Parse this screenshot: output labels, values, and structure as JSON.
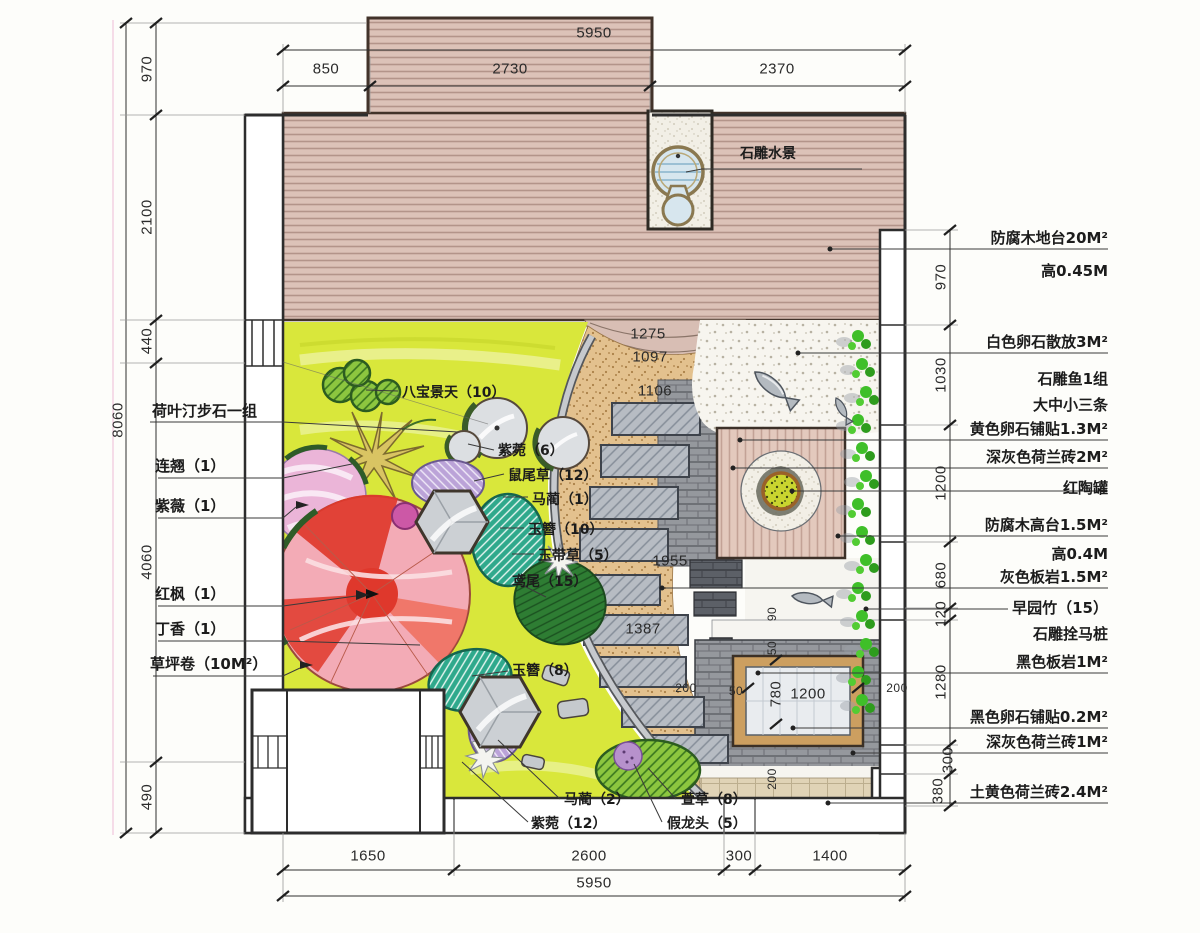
{
  "drawing": {
    "kind": "garden-landscape-plan",
    "colors": {
      "lawn": "#d9e73b",
      "deck_wood": "#dcc2b8",
      "deck_stripe": "#b3948a",
      "sand_path": "#e3c18e",
      "slate_slab": "#b7bcc3",
      "grey_brick": "#95989d",
      "black_slate": "#5c6067",
      "platform_wood": "#e3c9bd",
      "pot_green": "#c9d52f",
      "bamboo_green": "#3fbf29",
      "maple_red": "#df382c",
      "maple_pink": "#f3abb6",
      "crape_pink": "#ebb5d8",
      "purple_plant": "#bba3d8",
      "teal_plant": "#2fa98c",
      "pebble_white": "#f7f5ef",
      "wood_frame": "#cc9f60"
    }
  },
  "dims": {
    "top": {
      "total": "5950",
      "segs": [
        "850",
        "2730",
        "2370"
      ]
    },
    "bottom": {
      "total": "5950",
      "segs": [
        "1650",
        "2600",
        "300",
        "1400"
      ]
    },
    "left": {
      "total": "8060",
      "segs": [
        "970",
        "2100",
        "440",
        "4060",
        "490"
      ]
    },
    "right": {
      "segs": [
        "970",
        "1030",
        "1200",
        "680",
        "120",
        "1280",
        "300",
        "380"
      ]
    },
    "inner": [
      "1275",
      "1097",
      "1106",
      "1955",
      "1387",
      "90",
      "50",
      "200",
      "50",
      "780",
      "1200",
      "200",
      "200"
    ]
  },
  "ann": {
    "left": [
      "荷叶汀步石一组",
      "连翘（1）",
      "紫薇（1）",
      "红枫（1）",
      "丁香（1）",
      "草坪卷（10M²）"
    ],
    "right": [
      "防腐木地台20M²",
      "高0.45M",
      "白色卵石散放3M²",
      "石雕鱼1组",
      "大中小三条",
      "黄色卵石铺贴1.3M²",
      "深灰色荷兰砖2M²",
      "红陶罐",
      "防腐木高台1.5M²",
      "高0.4M",
      "灰色板岩1.5M²",
      "早园竹（15）",
      "石雕拴马桩",
      "黑色板岩1M²",
      "黑色卵石铺贴0.2M²",
      "深灰色荷兰砖1M²",
      "土黄色荷兰砖2.4M²"
    ],
    "inner": [
      "八宝景天（10）",
      "紫菀（6）",
      "鼠尾草（12）",
      "马蔺（1）",
      "玉簪（10）",
      "玉带草（5）",
      "鸢尾（15）",
      "玉簪（8）",
      "马蔺（2）",
      "紫菀（12）",
      "萱草（8）",
      "假龙头（5）",
      "石雕水景"
    ]
  }
}
